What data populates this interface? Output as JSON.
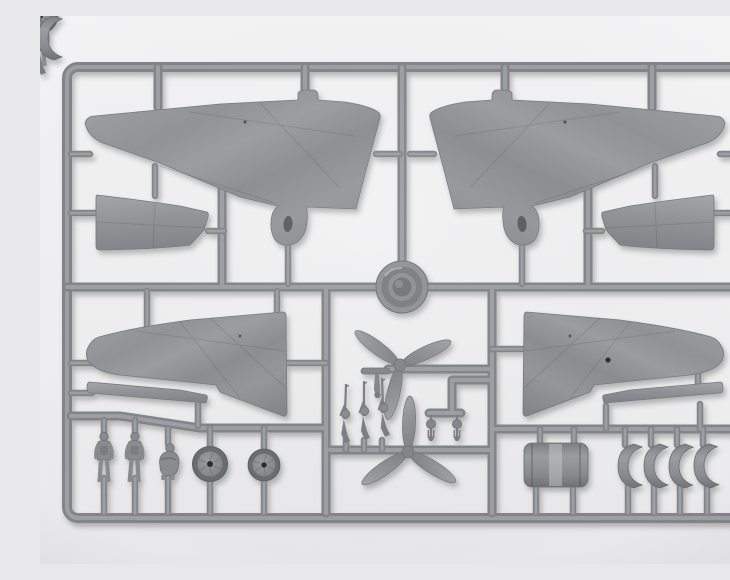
{
  "scene": {
    "type": "photograph",
    "subject": "plastic model kit sprue",
    "description": "Gray injection-molded sprue (runner frame) holding aircraft model parts: wing halves, flap sections, two three-blade propellers, a cowl ring, machine guns, crew figures, wheels and engine cowling pieces on a light background",
    "background_color": "#f1f1f2",
    "plastic_color": "#8e9092",
    "highlight_color": "#a6a8ab",
    "shadow_color": "rgba(0,0,0,0.28)"
  },
  "parts": [
    {
      "name": "upper wing half left",
      "count": 1
    },
    {
      "name": "upper wing half right",
      "count": 1
    },
    {
      "name": "lower wing half left",
      "count": 1
    },
    {
      "name": "lower wing half right",
      "count": 1
    },
    {
      "name": "flap aileron section left",
      "count": 1
    },
    {
      "name": "flap aileron section right",
      "count": 1
    },
    {
      "name": "narrow wing strip left",
      "count": 1
    },
    {
      "name": "narrow wing strip right",
      "count": 1
    },
    {
      "name": "cowl front ring",
      "count": 1
    },
    {
      "name": "three blade propeller upper",
      "count": 1
    },
    {
      "name": "three blade propeller lower",
      "count": 1
    },
    {
      "name": "machine gun",
      "count": 3
    },
    {
      "name": "standing crew figure",
      "count": 2
    },
    {
      "name": "seated crew figure",
      "count": 1
    },
    {
      "name": "main wheel",
      "count": 2
    },
    {
      "name": "tail strut",
      "count": 1
    },
    {
      "name": "tail wheel",
      "count": 2
    },
    {
      "name": "engine cowling barrel",
      "count": 1
    },
    {
      "name": "cowling ring segment",
      "count": 4
    }
  ]
}
